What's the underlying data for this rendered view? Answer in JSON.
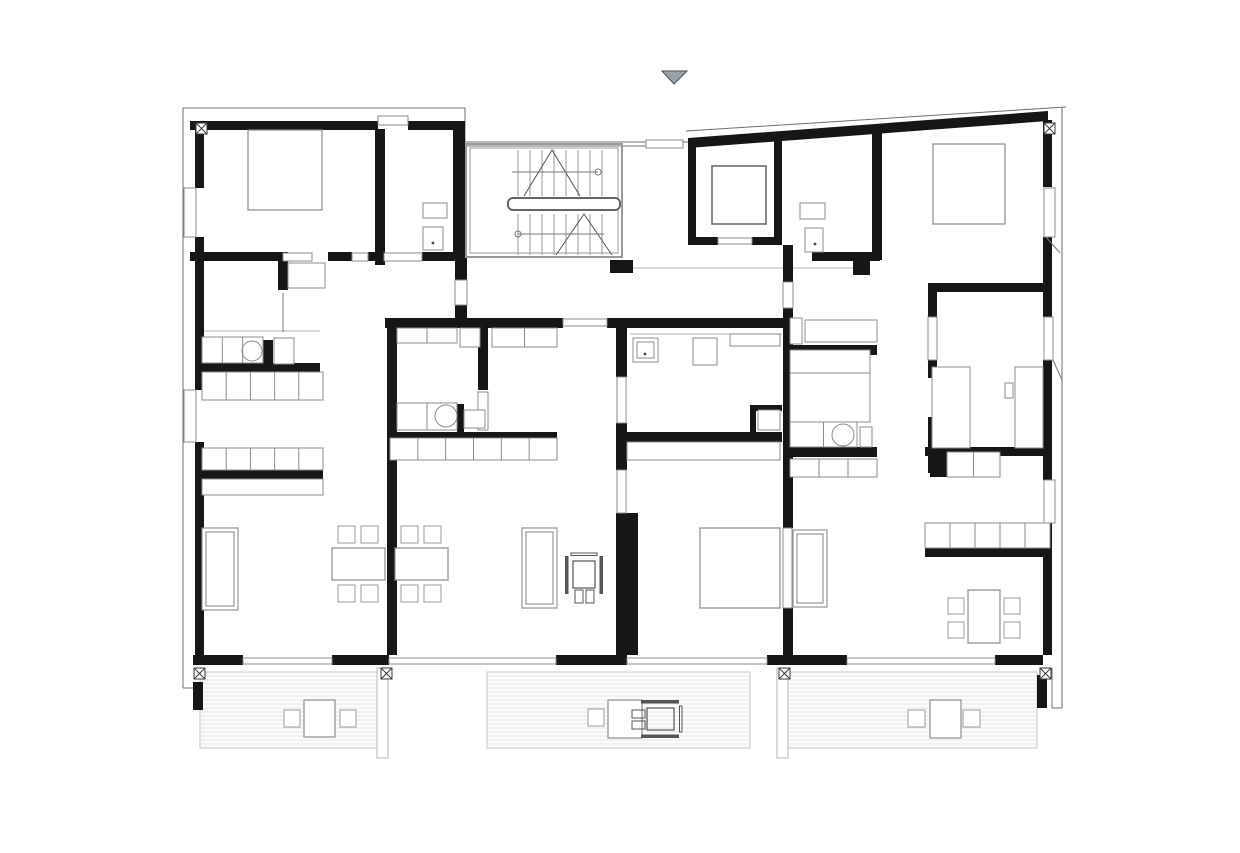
{
  "title": "apartment-floor-plan",
  "canvas": {
    "width": 1240,
    "height": 853,
    "background": "#ffffff"
  },
  "palette": {
    "wall": "#161616",
    "outline": "#6f6f6f",
    "light": "#a8a8a8",
    "fixture": "#8c8c8c",
    "furniture": "#9b9b9b",
    "deck_fill": "#fbfbfb",
    "deck_line": "#e7e7e7",
    "deck_edge": "#c6c6c6",
    "marker_fill": "#9aa1a6",
    "marker_edge": "#4a4f54",
    "stair": "#999999",
    "rail": "#666666"
  },
  "elements": [
    {
      "name": "terrace-deck",
      "type": "deck",
      "items": [
        [
          200,
          672,
          177,
          76
        ],
        [
          487,
          672,
          263,
          76
        ],
        [
          788,
          672,
          249,
          76
        ]
      ]
    },
    {
      "name": "terrace-pier",
      "type": "rect",
      "style": {
        "fill": "#ffffff",
        "stroke": "#b5b5b5",
        "w": 1
      },
      "items": [
        [
          377,
          668,
          11,
          90
        ],
        [
          777,
          668,
          11,
          90
        ]
      ]
    },
    {
      "name": "facade-outline",
      "type": "line",
      "style": {
        "stroke": "#6f6f6f",
        "w": 1
      },
      "items": [
        [
          183,
          108,
          465,
          108
        ],
        [
          183,
          108,
          183,
          688
        ],
        [
          183,
          688,
          200,
          688
        ],
        [
          465,
          108,
          465,
          142
        ],
        [
          465,
          142,
          646,
          142
        ],
        [
          683,
          142,
          688,
          142
        ],
        [
          465,
          146,
          646,
          146
        ],
        [
          686,
          131,
          1066,
          107
        ],
        [
          1062,
          107,
          1062,
          708
        ],
        [
          1052,
          708,
          1062,
          708
        ],
        [
          1052,
          668,
          1052,
          708
        ]
      ]
    },
    {
      "name": "floor-edge-line",
      "type": "line",
      "style": {
        "stroke": "#b5b5b5",
        "w": 1
      },
      "items": [
        [
          633,
          268,
          853,
          268
        ],
        [
          630,
          334,
          782,
          334
        ],
        [
          202,
          331,
          320,
          331
        ]
      ]
    },
    {
      "name": "exterior-interior-wall",
      "type": "wall",
      "items": [
        [
          190,
          121,
          188,
          9
        ],
        [
          408,
          121,
          57,
          9
        ],
        [
          195,
          121,
          9,
          67
        ],
        [
          195,
          237,
          9,
          153
        ],
        [
          195,
          442,
          9,
          220
        ],
        [
          193,
          655,
          50,
          10
        ],
        [
          332,
          655,
          57,
          10
        ],
        [
          556,
          655,
          71,
          10
        ],
        [
          767,
          655,
          80,
          10
        ],
        [
          995,
          655,
          48,
          10
        ],
        [
          1043,
          120,
          9,
          67
        ],
        [
          1043,
          237,
          9,
          80
        ],
        [
          1043,
          360,
          9,
          120
        ],
        [
          1043,
          523,
          9,
          132
        ],
        [
          375,
          129,
          10,
          136
        ],
        [
          453,
          121,
          12,
          131
        ],
        [
          455,
          252,
          12,
          28
        ],
        [
          455,
          305,
          12,
          13
        ],
        [
          190,
          252,
          88,
          9
        ],
        [
          328,
          252,
          24,
          9
        ],
        [
          368,
          252,
          15,
          9
        ],
        [
          422,
          252,
          45,
          9
        ],
        [
          278,
          252,
          10,
          38
        ],
        [
          387,
          318,
          10,
          337
        ],
        [
          385,
          318,
          178,
          10
        ],
        [
          607,
          318,
          176,
          10
        ],
        [
          616,
          318,
          11,
          59
        ],
        [
          616,
          423,
          11,
          47
        ],
        [
          616,
          513,
          22,
          142
        ],
        [
          783,
          245,
          10,
          37
        ],
        [
          783,
          308,
          10,
          220
        ],
        [
          783,
          608,
          10,
          47
        ],
        [
          688,
          139,
          8,
          106
        ],
        [
          774,
          136,
          8,
          109
        ],
        [
          688,
          237,
          30,
          8
        ],
        [
          752,
          237,
          30,
          8
        ],
        [
          610,
          260,
          23,
          13
        ],
        [
          853,
          260,
          17,
          15
        ],
        [
          872,
          128,
          10,
          132
        ],
        [
          812,
          252,
          68,
          9
        ],
        [
          788,
          345,
          89,
          10
        ],
        [
          788,
          447,
          89,
          10
        ],
        [
          925,
          447,
          125,
          9
        ],
        [
          930,
          456,
          17,
          21
        ],
        [
          928,
          283,
          122,
          9
        ],
        [
          928,
          292,
          9,
          25
        ],
        [
          928,
          360,
          9,
          18
        ],
        [
          928,
          417,
          9,
          56
        ],
        [
          925,
          548,
          122,
          9
        ],
        [
          195,
          363,
          125,
          9
        ],
        [
          195,
          470,
          128,
          9
        ],
        [
          478,
          328,
          10,
          62
        ],
        [
          387,
          432,
          170,
          9
        ],
        [
          457,
          404,
          7,
          28
        ],
        [
          263,
          340,
          10,
          25
        ],
        [
          625,
          432,
          157,
          10
        ],
        [
          750,
          405,
          6,
          30
        ],
        [
          750,
          405,
          32,
          6
        ],
        [
          193,
          682,
          10,
          28
        ],
        [
          1037,
          675,
          10,
          33
        ]
      ]
    },
    {
      "name": "slanted-roof-wall",
      "type": "poly",
      "style": {
        "fill": "#161616"
      },
      "items": [
        "688,138 1048,111 1048,121 688,148"
      ]
    },
    {
      "name": "window",
      "type": "rect",
      "style": {
        "fill": "#ffffff",
        "stroke": "#8c8c8c",
        "w": 1
      },
      "items": [
        [
          184,
          188,
          12,
          49
        ],
        [
          184,
          390,
          12,
          52
        ],
        [
          1044,
          188,
          11,
          49
        ],
        [
          1044,
          317,
          9,
          43
        ],
        [
          1044,
          480,
          11,
          43
        ],
        [
          243,
          658,
          89,
          6
        ],
        [
          389,
          658,
          167,
          6
        ],
        [
          627,
          658,
          140,
          6
        ],
        [
          847,
          658,
          148,
          6
        ],
        [
          617,
          377,
          9,
          46
        ],
        [
          617,
          470,
          9,
          43
        ],
        [
          928,
          317,
          9,
          43
        ],
        [
          783,
          528,
          9,
          80
        ],
        [
          478,
          392,
          10,
          38
        ],
        [
          563,
          319,
          44,
          7
        ],
        [
          783,
          282,
          10,
          26
        ],
        [
          378,
          116,
          30,
          9
        ],
        [
          646,
          140,
          37,
          8
        ],
        [
          718,
          238,
          34,
          6
        ],
        [
          455,
          280,
          12,
          25
        ],
        [
          352,
          253,
          16,
          8
        ],
        [
          283,
          253,
          29,
          8
        ],
        [
          384,
          253,
          38,
          8
        ]
      ]
    },
    {
      "name": "door-swing-line",
      "type": "line",
      "style": {
        "stroke": "#7a7a7a",
        "w": 1
      },
      "items": [
        [
          1046,
          237,
          1060,
          253
        ],
        [
          1053,
          360,
          1062,
          380
        ],
        [
          283,
          293,
          283,
          332
        ]
      ]
    },
    {
      "name": "kitchen-bath-fixture",
      "type": "cells",
      "style": {
        "stroke": "#8c8c8c",
        "w": 1
      },
      "items": [
        [
          202,
          337,
          61,
          26,
          3
        ],
        [
          274,
          338,
          20,
          26,
          1
        ],
        [
          202,
          372,
          121,
          28,
          5
        ],
        [
          202,
          448,
          121,
          22,
          5
        ],
        [
          202,
          479,
          121,
          16,
          1
        ],
        [
          288,
          263,
          37,
          25,
          1
        ],
        [
          423,
          203,
          24,
          15,
          1
        ],
        [
          423,
          227,
          20,
          23,
          1
        ],
        [
          397,
          328,
          60,
          15,
          2
        ],
        [
          460,
          328,
          20,
          19,
          1
        ],
        [
          492,
          328,
          65,
          19,
          2
        ],
        [
          397,
          403,
          60,
          27,
          2
        ],
        [
          464,
          410,
          21,
          18,
          1
        ],
        [
          390,
          438,
          167,
          22,
          6
        ],
        [
          633,
          338,
          25,
          24,
          1
        ],
        [
          637,
          342,
          17,
          16,
          1
        ],
        [
          693,
          338,
          24,
          27,
          1
        ],
        [
          758,
          410,
          22,
          20,
          1
        ],
        [
          730,
          334,
          50,
          12,
          1
        ],
        [
          627,
          442,
          153,
          18,
          1
        ],
        [
          790,
          318,
          12,
          26,
          1
        ],
        [
          805,
          320,
          72,
          22,
          1
        ],
        [
          790,
          350,
          80,
          23,
          1
        ],
        [
          790,
          373,
          80,
          49,
          1
        ],
        [
          790,
          422,
          67,
          25,
          2
        ],
        [
          860,
          427,
          12,
          20,
          1
        ],
        [
          790,
          459,
          87,
          18,
          3
        ],
        [
          800,
          203,
          25,
          16,
          1
        ],
        [
          805,
          228,
          18,
          24,
          1
        ],
        [
          925,
          523,
          125,
          25,
          5
        ],
        [
          947,
          452,
          53,
          25,
          2
        ],
        [
          932,
          367,
          38,
          81,
          1
        ],
        [
          1015,
          367,
          28,
          81,
          1
        ],
        [
          1005,
          383,
          8,
          15,
          1
        ]
      ]
    },
    {
      "name": "sink",
      "type": "circle",
      "style": {
        "stroke": "#8c8c8c",
        "w": 1
      },
      "items": [
        [
          252,
          351,
          10
        ],
        [
          446,
          416,
          11
        ],
        [
          843,
          435,
          11
        ]
      ]
    },
    {
      "name": "drain-dot",
      "type": "dot",
      "style": {
        "fill": "#444444"
      },
      "items": [
        [
          433,
          243
        ],
        [
          645,
          354
        ],
        [
          815,
          244
        ]
      ]
    },
    {
      "name": "bed",
      "type": "rect",
      "style": {
        "fill": "#ffffff",
        "stroke": "#8c8c8c",
        "w": 1.2
      },
      "items": [
        [
          248,
          130,
          74,
          80
        ],
        [
          933,
          144,
          72,
          80
        ],
        [
          700,
          528,
          80,
          80
        ]
      ]
    },
    {
      "name": "sofa",
      "type": "sofa",
      "style": {
        "stroke": "#8c8c8c",
        "w": 1.1
      },
      "items": [
        [
          202,
          528,
          36,
          82
        ],
        [
          522,
          528,
          35,
          80
        ],
        [
          793,
          530,
          34,
          77
        ]
      ]
    },
    {
      "name": "table",
      "type": "rect",
      "style": {
        "fill": "#ffffff",
        "stroke": "#8c8c8c",
        "w": 1.2
      },
      "items": [
        [
          332,
          548,
          53,
          32
        ],
        [
          395,
          548,
          53,
          32
        ],
        [
          968,
          590,
          32,
          53
        ],
        [
          304,
          700,
          31,
          37
        ],
        [
          608,
          700,
          34,
          38
        ],
        [
          930,
          700,
          31,
          38
        ]
      ]
    },
    {
      "name": "chair",
      "type": "rect",
      "style": {
        "fill": "#ffffff",
        "stroke": "#9b9b9b",
        "w": 1
      },
      "items": [
        [
          338,
          526,
          17,
          17
        ],
        [
          361,
          526,
          17,
          17
        ],
        [
          338,
          585,
          17,
          17
        ],
        [
          361,
          585,
          17,
          17
        ],
        [
          401,
          526,
          17,
          17
        ],
        [
          424,
          526,
          17,
          17
        ],
        [
          401,
          585,
          17,
          17
        ],
        [
          424,
          585,
          17,
          17
        ],
        [
          948,
          598,
          16,
          16
        ],
        [
          948,
          622,
          16,
          16
        ],
        [
          1004,
          598,
          16,
          16
        ],
        [
          1004,
          622,
          16,
          16
        ],
        [
          284,
          710,
          16,
          17
        ],
        [
          340,
          710,
          16,
          17
        ],
        [
          588,
          709,
          16,
          17
        ],
        [
          908,
          710,
          17,
          17
        ],
        [
          963,
          710,
          17,
          17
        ]
      ]
    },
    {
      "name": "staircase",
      "type": "stair",
      "def": {
        "frame": [
          466,
          144,
          156,
          113
        ],
        "inner": [
          470,
          148,
          148,
          105
        ],
        "tread_x": [
          518,
          602,
          12
        ],
        "flight1_y": [
          150,
          196
        ],
        "flight2_y": [
          214,
          255
        ],
        "rail": [
          508,
          198,
          112,
          12
        ],
        "zig1": "524,196 552,150 580,196",
        "zig2": "556,255 584,214 612,255",
        "arrow1": [
          512,
          172,
          598,
          172
        ],
        "arrow2": [
          518,
          234,
          604,
          234
        ],
        "circle1": [
          598,
          172
        ],
        "circle2": [
          518,
          234
        ]
      }
    },
    {
      "name": "elevator-car",
      "type": "rect",
      "style": {
        "fill": "none",
        "stroke": "#666666",
        "w": 1.5
      },
      "items": [
        [
          712,
          166,
          54,
          58
        ]
      ]
    },
    {
      "name": "column-marker",
      "type": "marker",
      "items": [
        [
          194,
          668
        ],
        [
          381,
          668
        ],
        [
          779,
          668
        ],
        [
          1040,
          668
        ],
        [
          196,
          123
        ],
        [
          1044,
          123
        ]
      ]
    },
    {
      "name": "wheelchair-icon",
      "type": "wheelchair",
      "items": [
        [
          565,
          550,
          0
        ],
        [
          641,
          694,
          90
        ]
      ]
    },
    {
      "name": "entrance-marker",
      "type": "poly",
      "style": {
        "fill": "#9aa1a6",
        "stroke": "#4a4f54",
        "w": 1
      },
      "items": [
        "662,71 687,71 674,84"
      ]
    }
  ]
}
